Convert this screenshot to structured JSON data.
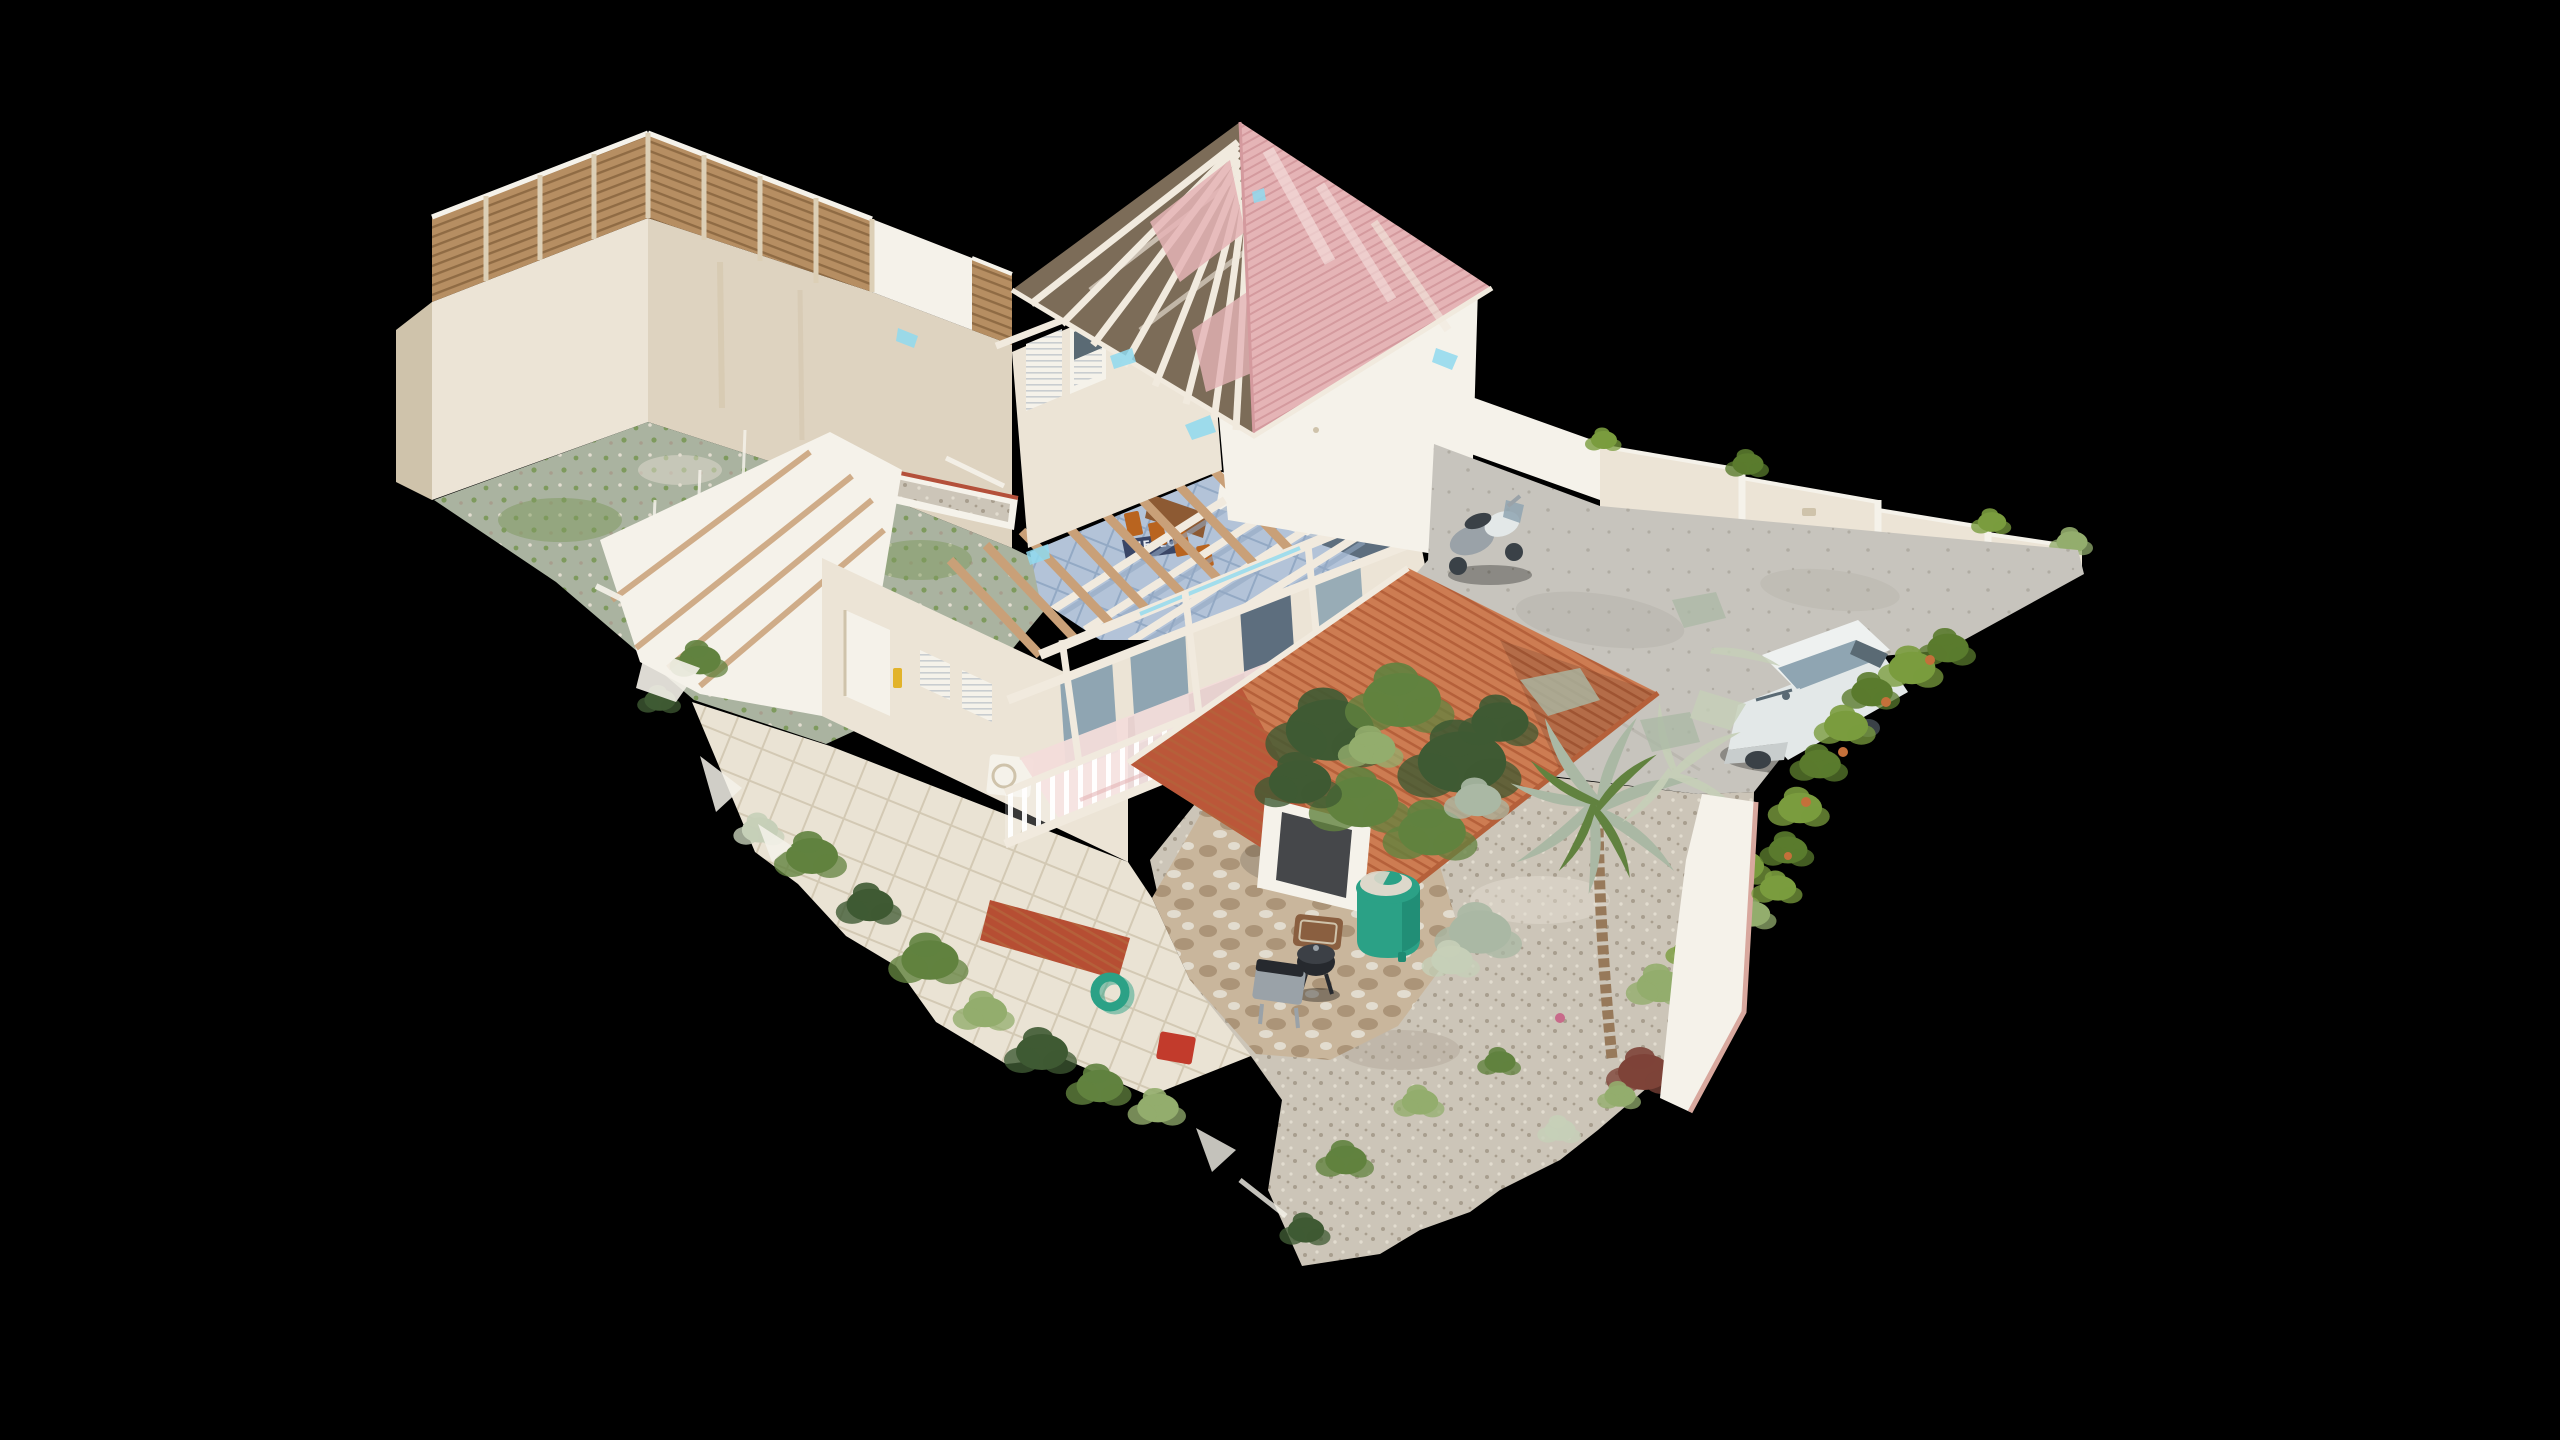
{
  "viewer": {
    "type": "3d-dollhouse-scan",
    "doormat_text": "HELLO"
  },
  "scene_objects": [
    "background",
    "dollhouse-model",
    "courtyard-fence",
    "courtyard-wall",
    "courtyard-ground",
    "planter-bed",
    "antenna-poles",
    "west-rooms-cutaway",
    "side-patio",
    "house-wall-west",
    "side-door",
    "ac-unit",
    "shuttered-window",
    "interior-floor",
    "hello-doormat",
    "dining-chairs",
    "kitchen-units",
    "interior-rafters",
    "veranda-glass-doors",
    "veranda-deck",
    "balcony-railing",
    "veranda-posts",
    "veranda-roof-rafters",
    "upper-house-gable-west",
    "upper-house-gable-south",
    "upper-roof-exposed-rafters",
    "upper-roof-pink",
    "roof-glitches",
    "terrace-parapet",
    "boundary-wall",
    "wall-plants",
    "driveway",
    "scooter",
    "suv-car",
    "garden-gravel",
    "stone-patio",
    "water-tank",
    "bbq-grill",
    "grill-cart",
    "manhole-cover",
    "garden-hose",
    "storage-crate",
    "screen-porch",
    "awning",
    "garden-tree",
    "palm-tree",
    "garden-shrubs",
    "red-plant",
    "border-plants",
    "hedge",
    "garden-wall",
    "mesh-debris"
  ],
  "palette": {
    "background": "#000000",
    "wall_light": "#ece4d6",
    "wall_mid": "#ded3c0",
    "wall_shadow": "#cfc3ab",
    "wall_white": "#f5f2ea",
    "wall_stain": "#d0c0a4",
    "fence_wood": "#b68e62",
    "fence_wood_dark": "#8f6b44",
    "fence_frame": "#dccfb6",
    "roof_pink": "#e5b4b6",
    "roof_pink_dark": "#d49a9e",
    "roof_pink_pale": "#f3dcda",
    "rafter_white": "#f1eade",
    "rafter_tan": "#c9a078",
    "roof_cavity": "#7c6c58",
    "awning_orange": "#cd7c52",
    "awning_orange_dark": "#b5603a",
    "awning_red": "#b64e33",
    "interior_tile": "#b3c3d8",
    "interior_tile_line": "#93a9c4",
    "chair_orange": "#b9641f",
    "table_gray": "#5d6e7e",
    "doormat": "#3a4666",
    "doormat_text": "#e8ecf4",
    "patio_tile": "#eae3d4",
    "patio_tile_line": "#d3c9b4",
    "stone_paving": "#c9b69c",
    "stone_dark": "#ab9478",
    "gravel": "#ccc5b8",
    "gravel_dark": "#a89e8e",
    "gravel_light": "#e2dccf",
    "courtyard_ground": "#aab3a0",
    "courtyard_green": "#7e9a5d",
    "tank_teal": "#2ba186",
    "tank_teal_dark": "#1f8a72",
    "tank_lid": "#ddd8cb",
    "bbq_black": "#26292e",
    "metal_gray": "#9aa2a8",
    "car_white": "#e3e8e8",
    "car_glass": "#8fa5b2",
    "car_dark": "#5a6a74",
    "tire_dark": "#3a4147",
    "concrete": "#c7c4bd",
    "concrete_dark": "#b0aca3",
    "hedge_green": "#7a9c3e",
    "hedge_green_dark": "#5a7b2d",
    "hedge_orange": "#c4703a",
    "foliage_dark": "#3f5a33",
    "foliage_mid": "#61823f",
    "foliage_light": "#93ad6d",
    "foliage_silver": "#aab8a4",
    "foliage_pale": "#c6cfb8",
    "trunk_brown": "#97795a",
    "plant_red": "#7e4338",
    "sky_glitch": "#8fd9ef",
    "trim_pink": "#d8a89e",
    "red_obj": "#c23b2c",
    "yellow_obj": "#e2b32a",
    "purple_obj": "#b08cb4",
    "manhole_rust": "#8a5f40",
    "counter_brown": "#8d5a33"
  }
}
